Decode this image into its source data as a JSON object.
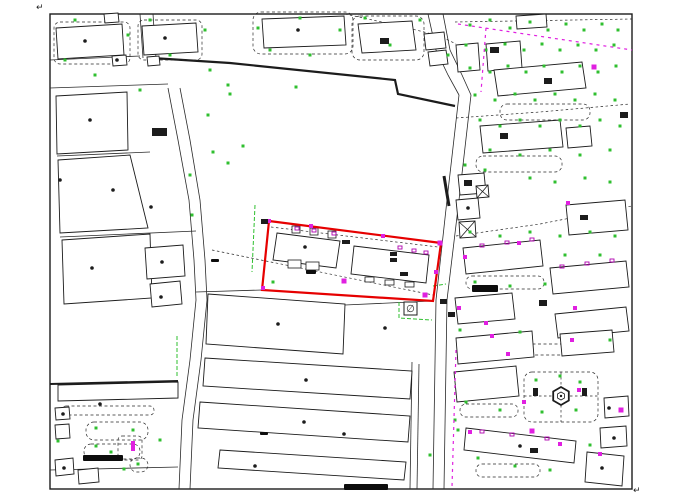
{
  "canvas": {
    "width": 683,
    "height": 503,
    "background": "#ffffff"
  },
  "colors": {
    "line": "#1c1c1c",
    "road": "#2a2a2a",
    "building_fill": "#ffffff",
    "parcel_red": "#e60000",
    "tree_green": "#2fbf2f",
    "marker_magenta": "#e020e0",
    "tick_purple": "#b000b0",
    "smudge_black": "#0d0d0d"
  },
  "symbols": {
    "corner_mark": "↵",
    "manhole_symbol": "∅"
  },
  "border": {
    "x": 50,
    "y": 14,
    "w": 582,
    "h": 475
  },
  "corner_marks": [
    [
      36,
      10
    ],
    [
      633,
      493
    ]
  ],
  "red_parcel": {
    "points": "269,221 441,243 433,301 262,290"
  },
  "manhole": {
    "x": 404,
    "y": 302,
    "size": 13
  },
  "park_hexagon": {
    "cx": 561,
    "cy": 396,
    "r": 9,
    "inner_r": 4
  },
  "thick_lines": [
    {
      "pts": "152,58 230,63 395,80 398,94 455,106",
      "w": 2.2
    },
    {
      "pts": "444,176 449,206",
      "w": 3
    },
    {
      "pts": "50,384 178,381",
      "w": 2
    }
  ],
  "roads": [
    "168,88 178,140 189,200 194,260 196,300 190,360 182,420 179,489",
    "180,88 190,140 200,200 205,260 207,300 201,360 193,420 190,489",
    "459,95 447,200 436,300 433,489",
    "471,95 459,200 447,300 444,489",
    "428,14 436,50 448,75 459,95",
    "443,14 450,50 462,75 471,95",
    "50,60 140,56",
    "50,88 168,84",
    "57,156 150,152",
    "60,237 196,231",
    "345,305 432,301",
    "412,362 410,489",
    "419,364 417,489",
    "50,470 178,467",
    "140,14 143,58",
    "153,14 156,58",
    "196,292 262,290"
  ],
  "dashed_polylines": [
    "456,118 540,112 630,104",
    "456,236 540,224 632,206",
    "345,14 400,26 440,36 456,44",
    "455,22 632,19",
    "271,227 438,247",
    "212,250 433,295",
    "561,372 561,387",
    "561,405 561,422",
    "524,396 552,396",
    "570,396 598,396"
  ],
  "magenta_dashed": [
    "458,24 632,50",
    "486,28 481,92",
    "456,350 452,487"
  ],
  "green_lines": [
    "255,205 252,272",
    "177,336 177,378",
    "399,302 399,318 432,320",
    "433,286 446,284"
  ],
  "buildings": [
    "56,28 122,24 124,55 58,59",
    "142,26 196,23 198,52 144,55",
    "112,56 126,55 127,65 113,66",
    "147,57 159,56 160,65 148,66",
    "104,14 118,13 119,22 105,23",
    "262,19 344,16 346,45 264,48",
    "358,24 412,21 416,50 362,53",
    "424,34 444,32 446,48 426,50",
    "428,52 446,50 448,64 430,66",
    "456,45 478,43 480,70 458,72",
    "486,44 520,41 522,68 488,71",
    "494,70 582,62 586,88 498,96",
    "516,16 546,14 547,27 517,29",
    "480,126 560,120 563,147 483,153",
    "566,128 590,126 592,146 568,148",
    "56,96 127,92 128,150 57,154",
    "58,160 130,155 148,228 60,233",
    "62,240 150,234 152,298 64,304",
    "145,248 183,245 185,276 147,279",
    "150,284 180,281 182,304 152,307",
    "208,294 345,304 343,354 206,344",
    "205,358 412,371 410,399 203,386",
    "200,402 410,416 408,442 198,428",
    "220,450 406,462 404,480 218,468",
    "58,385 178,382 178,398 58,401",
    "566,205 625,200 628,230 569,235",
    "463,248 540,240 543,266 466,274",
    "550,268 626,261 629,287 553,294",
    "455,298 512,293 515,319 458,324",
    "555,314 626,307 629,331 558,338",
    "456,338 532,331 534,357 458,364",
    "560,334 612,330 614,352 562,356",
    "454,372 516,366 519,396 457,402",
    "466,428 576,441 574,463 464,450",
    "587,452 624,456 622,486 585,482",
    "604,398 628,396 629,416 605,418",
    "600,428 626,426 627,446 601,448",
    "458,175 484,173 486,193 460,195",
    "456,200 478,198 480,218 458,220",
    "277,233 340,241 336,268 273,260",
    "354,246 429,255 426,283 351,274",
    "55,408 69,407 70,419 56,420",
    "55,425 69,424 70,438 56,439",
    "55,460 73,458 74,474 56,476",
    "78,470 98,468 99,482 79,484"
  ],
  "x_squares": [
    "459,222 475,221 476,237 460,238",
    "476,186 488,185 489,197 477,198"
  ],
  "small_rects": [
    [
      292,
      226,
      8,
      7
    ],
    [
      310,
      228,
      8,
      7
    ],
    [
      328,
      231,
      8,
      7
    ],
    [
      288,
      260,
      13,
      8
    ],
    [
      306,
      262,
      13,
      8
    ],
    [
      365,
      277,
      9,
      5
    ],
    [
      385,
      280,
      9,
      5
    ],
    [
      405,
      282,
      9,
      5
    ]
  ],
  "dashed_shapes": [
    [
      253,
      12,
      100,
      42,
      8
    ],
    [
      352,
      16,
      72,
      44,
      8
    ],
    [
      54,
      22,
      76,
      42,
      6
    ],
    [
      138,
      20,
      64,
      40,
      6
    ],
    [
      500,
      104,
      90,
      16,
      7
    ],
    [
      476,
      156,
      86,
      16,
      7
    ],
    [
      466,
      276,
      78,
      13,
      6
    ],
    [
      522,
      344,
      54,
      11,
      5
    ],
    [
      460,
      404,
      58,
      13,
      6
    ],
    [
      476,
      464,
      64,
      13,
      6
    ],
    [
      524,
      372,
      74,
      50,
      8
    ],
    [
      86,
      422,
      62,
      18,
      8
    ],
    [
      84,
      444,
      56,
      15,
      7
    ],
    [
      118,
      436,
      24,
      24,
      4
    ],
    [
      130,
      458,
      18,
      14,
      7
    ],
    [
      62,
      406,
      92,
      9,
      4
    ]
  ],
  "green_dots": [
    [
      75,
      20
    ],
    [
      128,
      35
    ],
    [
      150,
      20
    ],
    [
      205,
      30
    ],
    [
      170,
      55
    ],
    [
      95,
      75
    ],
    [
      210,
      70
    ],
    [
      65,
      60
    ],
    [
      140,
      90
    ],
    [
      228,
      85
    ],
    [
      258,
      28
    ],
    [
      300,
      18
    ],
    [
      340,
      30
    ],
    [
      365,
      18
    ],
    [
      390,
      45
    ],
    [
      420,
      20
    ],
    [
      448,
      55
    ],
    [
      310,
      55
    ],
    [
      270,
      50
    ],
    [
      230,
      94
    ],
    [
      243,
      146
    ],
    [
      296,
      87
    ],
    [
      208,
      115
    ],
    [
      213,
      152
    ],
    [
      190,
      175
    ],
    [
      192,
      215
    ],
    [
      228,
      163
    ],
    [
      273,
      282
    ],
    [
      470,
      25
    ],
    [
      490,
      20
    ],
    [
      510,
      28
    ],
    [
      530,
      22
    ],
    [
      548,
      30
    ],
    [
      566,
      24
    ],
    [
      584,
      30
    ],
    [
      602,
      24
    ],
    [
      618,
      30
    ],
    [
      466,
      45
    ],
    [
      486,
      50
    ],
    [
      505,
      44
    ],
    [
      524,
      50
    ],
    [
      542,
      44
    ],
    [
      560,
      50
    ],
    [
      578,
      45
    ],
    [
      596,
      50
    ],
    [
      614,
      45
    ],
    [
      470,
      68
    ],
    [
      490,
      72
    ],
    [
      508,
      66
    ],
    [
      526,
      72
    ],
    [
      544,
      66
    ],
    [
      562,
      72
    ],
    [
      580,
      66
    ],
    [
      598,
      72
    ],
    [
      616,
      66
    ],
    [
      475,
      95
    ],
    [
      495,
      100
    ],
    [
      515,
      94
    ],
    [
      535,
      100
    ],
    [
      555,
      94
    ],
    [
      575,
      100
    ],
    [
      595,
      94
    ],
    [
      615,
      100
    ],
    [
      480,
      120
    ],
    [
      500,
      126
    ],
    [
      520,
      120
    ],
    [
      540,
      126
    ],
    [
      560,
      120
    ],
    [
      580,
      126
    ],
    [
      600,
      120
    ],
    [
      620,
      126
    ],
    [
      490,
      150
    ],
    [
      520,
      155
    ],
    [
      550,
      150
    ],
    [
      580,
      155
    ],
    [
      610,
      150
    ],
    [
      465,
      165
    ],
    [
      485,
      170
    ],
    [
      530,
      178
    ],
    [
      555,
      182
    ],
    [
      585,
      178
    ],
    [
      610,
      182
    ],
    [
      470,
      232
    ],
    [
      500,
      236
    ],
    [
      530,
      232
    ],
    [
      560,
      236
    ],
    [
      590,
      232
    ],
    [
      615,
      236
    ],
    [
      475,
      282
    ],
    [
      510,
      286
    ],
    [
      545,
      284
    ],
    [
      565,
      255
    ],
    [
      600,
      255
    ],
    [
      460,
      330
    ],
    [
      520,
      332
    ],
    [
      610,
      340
    ],
    [
      536,
      380
    ],
    [
      580,
      382
    ],
    [
      542,
      412
    ],
    [
      576,
      410
    ],
    [
      560,
      376
    ],
    [
      466,
      402
    ],
    [
      500,
      410
    ],
    [
      455,
      420
    ],
    [
      478,
      458
    ],
    [
      515,
      466
    ],
    [
      550,
      470
    ],
    [
      590,
      445
    ],
    [
      96,
      428
    ],
    [
      133,
      430
    ],
    [
      111,
      452
    ],
    [
      96,
      446
    ],
    [
      138,
      464
    ],
    [
      124,
      469
    ],
    [
      58,
      441
    ],
    [
      160,
      440
    ],
    [
      430,
      455
    ],
    [
      458,
      430
    ]
  ],
  "magenta_markers": [
    [
      269,
      221,
      4,
      4
    ],
    [
      311,
      226,
      4,
      4
    ],
    [
      383,
      236,
      4,
      4
    ],
    [
      440,
      243,
      5,
      5
    ],
    [
      436,
      272,
      4,
      4
    ],
    [
      425,
      295,
      5,
      5
    ],
    [
      344,
      281,
      5,
      5
    ],
    [
      263,
      288,
      4,
      4
    ],
    [
      594,
      67,
      5,
      5
    ],
    [
      568,
      203,
      4,
      4
    ],
    [
      519,
      243,
      4,
      4
    ],
    [
      465,
      257,
      4,
      4
    ],
    [
      459,
      308,
      4,
      4
    ],
    [
      486,
      323,
      4,
      4
    ],
    [
      575,
      308,
      4,
      4
    ],
    [
      492,
      336,
      4,
      4
    ],
    [
      572,
      340,
      4,
      4
    ],
    [
      508,
      354,
      4,
      4
    ],
    [
      579,
      390,
      4,
      4
    ],
    [
      524,
      402,
      4,
      4
    ],
    [
      532,
      431,
      5,
      5
    ],
    [
      470,
      432,
      4,
      4
    ],
    [
      560,
      444,
      4,
      4
    ],
    [
      600,
      454,
      4,
      4
    ],
    [
      621,
      410,
      5,
      5
    ],
    [
      133,
      446,
      4,
      10
    ]
  ],
  "black_dots": [
    [
      85,
      41
    ],
    [
      165,
      38
    ],
    [
      298,
      30
    ],
    [
      90,
      120
    ],
    [
      60,
      180
    ],
    [
      113,
      190
    ],
    [
      151,
      207
    ],
    [
      92,
      268
    ],
    [
      162,
      262
    ],
    [
      161,
      297
    ],
    [
      278,
      324
    ],
    [
      306,
      380
    ],
    [
      304,
      422
    ],
    [
      344,
      434
    ],
    [
      255,
      466
    ],
    [
      100,
      404
    ],
    [
      63,
      414
    ],
    [
      64,
      468
    ],
    [
      520,
      446
    ],
    [
      602,
      468
    ],
    [
      305,
      247
    ],
    [
      117,
      60
    ],
    [
      468,
      208
    ],
    [
      609,
      408
    ],
    [
      614,
      438
    ],
    [
      385,
      328
    ]
  ],
  "solid_rects": [
    [
      261,
      219,
      7,
      5
    ],
    [
      152,
      128,
      15,
      8
    ],
    [
      380,
      38,
      9,
      6
    ],
    [
      490,
      47,
      9,
      6
    ],
    [
      544,
      78,
      8,
      6
    ],
    [
      500,
      133,
      8,
      6
    ],
    [
      464,
      180,
      8,
      6
    ],
    [
      580,
      215,
      8,
      5
    ],
    [
      539,
      300,
      8,
      6
    ],
    [
      530,
      448,
      8,
      5
    ],
    [
      440,
      299,
      7,
      5
    ],
    [
      448,
      312,
      7,
      5
    ],
    [
      342,
      240,
      8,
      4
    ],
    [
      390,
      252,
      7,
      4
    ],
    [
      390,
      258,
      7,
      4
    ],
    [
      400,
      272,
      8,
      4
    ],
    [
      533,
      388,
      5,
      8
    ],
    [
      582,
      388,
      5,
      8
    ],
    [
      620,
      112,
      8,
      6
    ]
  ],
  "ticks": [
    [
      295,
      227
    ],
    [
      312,
      229
    ],
    [
      332,
      232
    ],
    [
      398,
      246
    ],
    [
      412,
      249
    ],
    [
      424,
      251
    ],
    [
      480,
      244
    ],
    [
      505,
      241
    ],
    [
      530,
      238
    ],
    [
      560,
      265
    ],
    [
      585,
      262
    ],
    [
      610,
      259
    ],
    [
      480,
      430
    ],
    [
      510,
      433
    ],
    [
      545,
      437
    ]
  ],
  "smudges": [
    [
      83,
      455,
      40,
      6
    ],
    [
      344,
      484,
      44,
      6
    ],
    [
      472,
      285,
      26,
      7
    ],
    [
      306,
      270,
      10,
      4
    ],
    [
      211,
      259,
      8,
      3
    ],
    [
      260,
      432,
      8,
      3
    ]
  ]
}
